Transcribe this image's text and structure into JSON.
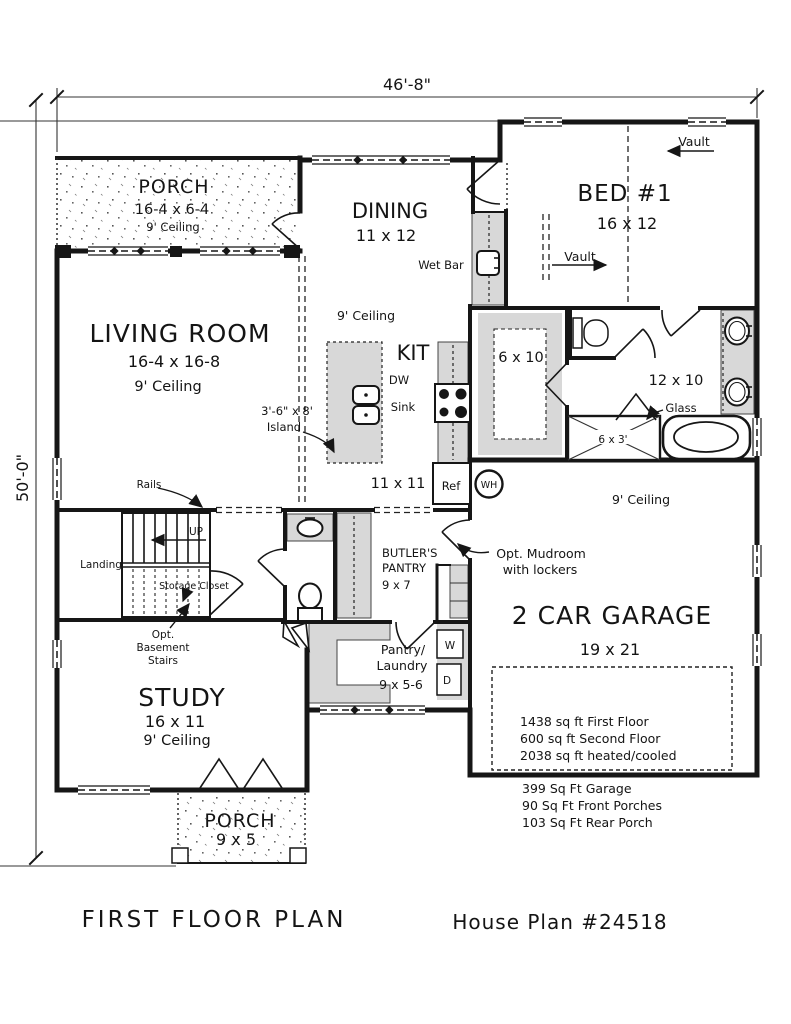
{
  "colors": {
    "ink": "#161616",
    "counter_gray": "#d8d8d8",
    "paper": "#ffffff"
  },
  "dimensions": {
    "width_label": "46'-8\"",
    "height_label": "50'-0\""
  },
  "footer": {
    "title": "FIRST FLOOR PLAN",
    "plan_number": "House Plan #24518"
  },
  "rooms": {
    "front_porch": {
      "name": "PORCH",
      "size": "16-4 x 6-4",
      "ceiling": "9' Ceiling"
    },
    "dining": {
      "name": "DINING",
      "size": "11 x 12"
    },
    "bed1": {
      "name": "BED #1",
      "size": "16 x 12",
      "vault_label": "Vault"
    },
    "wet_bar": {
      "label": "Wet Bar"
    },
    "living_room": {
      "name": "LIVING ROOM",
      "size": "16-4 x 16-8",
      "ceiling": "9' Ceiling"
    },
    "kitchen": {
      "name": "KIT",
      "size": "11 x 11",
      "ceiling": "9' Ceiling",
      "dw": "DW",
      "sink": "Sink",
      "ref": "Ref",
      "island_line1": "3'-6\" x 8'",
      "island_line2": "Island",
      "water_heater": "WH"
    },
    "closet": {
      "size": "6 x 10"
    },
    "bath": {
      "size": "12 x 10",
      "glass": "Glass",
      "shower_size": "6 x 3'"
    },
    "garage": {
      "name": "2 CAR GARAGE",
      "size": "19 x 21",
      "ceiling": "9' Ceiling"
    },
    "butlers_pantry": {
      "line1": "BUTLER'S",
      "line2": "PANTRY",
      "size": "9 x 7"
    },
    "mudroom": {
      "line1": "Opt. Mudroom",
      "line2": "with lockers"
    },
    "laundry": {
      "line1": "Pantry/",
      "line2": "Laundry",
      "size": "9 x 5-6",
      "washer": "W",
      "dryer": "D"
    },
    "stairs": {
      "rails": "Rails",
      "up": "UP",
      "landing": "Landing",
      "storage": "Storage Closet",
      "opt_line1": "Opt.",
      "opt_line2": "Basement",
      "opt_line3": "Stairs"
    },
    "study": {
      "name": "STUDY",
      "size": "16 x 11",
      "ceiling": "9' Ceiling"
    },
    "rear_porch": {
      "name": "PORCH",
      "size": "9 x 5"
    }
  },
  "area_table": {
    "inside": [
      "1438 sq ft First Floor",
      "600 sq ft Second Floor",
      "2038 sq ft heated/cooled"
    ],
    "outside": [
      "399 Sq Ft Garage",
      "90 Sq Ft Front Porches",
      "103 Sq Ft Rear Porch"
    ]
  }
}
